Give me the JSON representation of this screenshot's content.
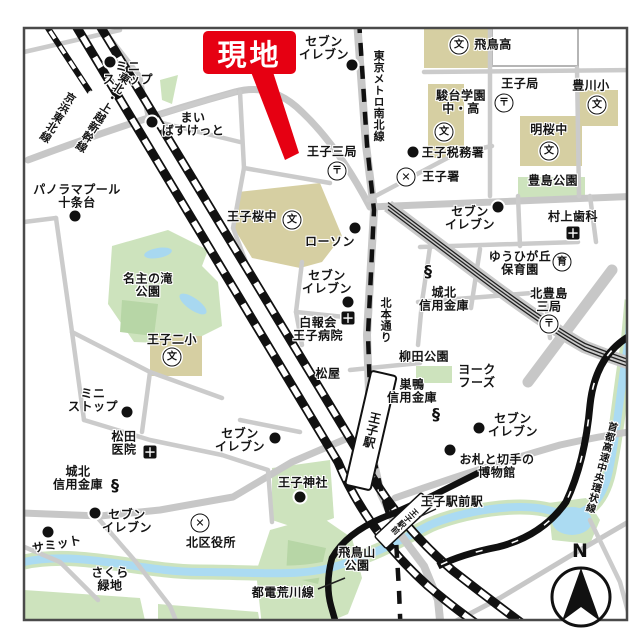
{
  "map": {
    "callout": {
      "text": "現地"
    },
    "compass_label": "N",
    "glyphs": {
      "dot": "",
      "school": "文",
      "post": "〒",
      "police": "✕",
      "hospital": "＋",
      "bank": "§",
      "nursery": "育"
    },
    "text_labels": [
      {
        "name": "label-ministop-top",
        "text": "ミニ\nストップ",
        "x": 128,
        "y": 74
      },
      {
        "name": "label-maibasuketto",
        "text": "まい\nばすけっと",
        "x": 193,
        "y": 125
      },
      {
        "name": "label-seven-eleven-top",
        "text": "セブン\nイレブン",
        "x": 324,
        "y": 49
      },
      {
        "name": "label-tokyo-metro-namboku-line",
        "text": "東京メトロ南北線",
        "x": 378,
        "y": 96,
        "v": 1,
        "size": 11
      },
      {
        "name": "label-oji-san-post-office",
        "text": "王子三局",
        "x": 332,
        "y": 152
      },
      {
        "name": "label-oji-tax-office",
        "text": "王子税務署",
        "x": 453,
        "y": 153
      },
      {
        "name": "label-oji-police-station",
        "text": "王子署",
        "x": 441,
        "y": 177
      },
      {
        "name": "label-asuka-high-school",
        "text": "飛鳥高",
        "x": 493,
        "y": 45
      },
      {
        "name": "label-sundai-gakuen",
        "text": "駿台学園\n中・高",
        "x": 461,
        "y": 103
      },
      {
        "name": "label-oji-post-office",
        "text": "王子局",
        "x": 520,
        "y": 84
      },
      {
        "name": "label-toyokawa-elementary",
        "text": "豊川小",
        "x": 591,
        "y": 86
      },
      {
        "name": "label-meio-middle-school",
        "text": "明桜中",
        "x": 549,
        "y": 130
      },
      {
        "name": "label-toshima-park",
        "text": "豊島公園",
        "x": 553,
        "y": 181
      },
      {
        "name": "label-murakami-dental",
        "text": "村上歯科",
        "x": 573,
        "y": 217
      },
      {
        "name": "label-seven-eleven-right",
        "text": "セブン\nイレブン",
        "x": 470,
        "y": 219
      },
      {
        "name": "label-yuhigaoka-nursery",
        "text": "ゆうひが丘\n保育園",
        "x": 520,
        "y": 264
      },
      {
        "name": "label-kitatoshima-post-office",
        "text": "北豊島\n三局",
        "x": 549,
        "y": 301
      },
      {
        "name": "label-johoku-shinkin-right",
        "text": "城北\n信用金庫",
        "x": 444,
        "y": 300
      },
      {
        "name": "label-yanagida-park",
        "text": "柳田公園",
        "x": 424,
        "y": 357
      },
      {
        "name": "label-york-foods",
        "text": "ヨーク\nフーズ",
        "x": 477,
        "y": 377
      },
      {
        "name": "label-sugamo-shinkin",
        "text": "巣鴨\n信用金庫",
        "x": 412,
        "y": 392
      },
      {
        "name": "label-seven-eleven-bottom-right",
        "text": "セブン\nイレブン",
        "x": 513,
        "y": 426
      },
      {
        "name": "label-stamp-museum",
        "text": "お札と切手の\n博物館",
        "x": 497,
        "y": 467
      },
      {
        "name": "label-oji-ekimae-station",
        "text": "王子駅前駅",
        "x": 452,
        "y": 502
      },
      {
        "name": "label-shuto-expressway",
        "text": "首都高速中央環状線",
        "x": 600,
        "y": 467,
        "v": 1,
        "rot": 15,
        "size": 10
      },
      {
        "name": "label-oji-station",
        "text": "王子駅",
        "x": 371,
        "y": 430,
        "v": 1,
        "rot": 13,
        "size": 12
      },
      {
        "name": "label-asukayama-park",
        "text": "飛鳥山\n公園",
        "x": 357,
        "y": 560
      },
      {
        "name": "label-toden-arakawa-line",
        "text": "都電荒川線",
        "x": 283,
        "y": 593
      },
      {
        "name": "label-oji-shrine",
        "text": "王子神社",
        "x": 303,
        "y": 483
      },
      {
        "name": "label-kita-ward-office",
        "text": "北区役所",
        "x": 211,
        "y": 543
      },
      {
        "name": "label-seven-eleven-bottom-center",
        "text": "セブン\nイレブン",
        "x": 240,
        "y": 441
      },
      {
        "name": "label-summit",
        "text": "サミット",
        "x": 57,
        "y": 545,
        "rot": -10
      },
      {
        "name": "label-seven-eleven-left",
        "text": "セブン\nイレブン",
        "x": 127,
        "y": 522
      },
      {
        "name": "label-johoku-shinkin-left",
        "text": "城北\n信用金庫",
        "x": 78,
        "y": 479
      },
      {
        "name": "label-matsuda-clinic",
        "text": "松田\n医院",
        "x": 124,
        "y": 444
      },
      {
        "name": "label-ministop-left",
        "text": "ミニ\nストップ",
        "x": 93,
        "y": 401
      },
      {
        "name": "label-sakura-ryokuchi",
        "text": "さくら\n緑地",
        "x": 110,
        "y": 580
      },
      {
        "name": "label-seven-eleven-mid",
        "text": "セブン\nイレブン",
        "x": 327,
        "y": 283
      },
      {
        "name": "label-hakuhokai-oji-hospital",
        "text": "白報会\n王子病院",
        "x": 318,
        "y": 330
      },
      {
        "name": "label-kitamoto-dori",
        "text": "北本通り",
        "x": 385,
        "y": 320,
        "v": 1,
        "size": 11
      },
      {
        "name": "label-matsuya",
        "text": "松屋",
        "x": 328,
        "y": 374
      },
      {
        "name": "label-nanushi-falls-park",
        "text": "名主の滝\n公園",
        "x": 148,
        "y": 286
      },
      {
        "name": "label-oji-2-elementary",
        "text": "王子二小",
        "x": 172,
        "y": 340
      },
      {
        "name": "label-panorama-pool",
        "text": "パノラマプール\n十条台",
        "x": 77,
        "y": 197
      },
      {
        "name": "label-oji-sakura-middle",
        "text": "王子桜中",
        "x": 252,
        "y": 217
      },
      {
        "name": "label-lawson",
        "text": "ローソン",
        "x": 330,
        "y": 242
      },
      {
        "name": "label-tohoku-joetsu-shinkansen",
        "text": "東北・上越新幹線",
        "x": 102,
        "y": 112,
        "v": 1,
        "rot": 32,
        "size": 11
      },
      {
        "name": "label-keihin-tohoku-line",
        "text": "京浜東北線",
        "x": 57,
        "y": 117,
        "v": 1,
        "rot": 32,
        "size": 11
      },
      {
        "name": "label-oji-ekimae-box",
        "text": "王子駅前",
        "x": 404,
        "y": 521,
        "v": 1,
        "rot": 47,
        "size": 8
      }
    ],
    "poi_icons": [
      {
        "name": "icon-ministop-top-dot",
        "kind": "dot",
        "x": 110,
        "y": 62
      },
      {
        "name": "icon-maibasuketto-dot",
        "kind": "dot",
        "x": 152,
        "y": 122
      },
      {
        "name": "icon-seven-top-dot",
        "kind": "dot",
        "x": 352,
        "y": 65
      },
      {
        "name": "icon-oji-tax-dot",
        "kind": "dot",
        "x": 413,
        "y": 152
      },
      {
        "name": "icon-seven-right-dot",
        "kind": "dot",
        "x": 498,
        "y": 207
      },
      {
        "name": "icon-seven-bottom-right-dot",
        "kind": "dot",
        "x": 479,
        "y": 428
      },
      {
        "name": "icon-stamp-museum-dot",
        "kind": "dot",
        "x": 450,
        "y": 450
      },
      {
        "name": "icon-oji-shrine-dot",
        "kind": "dot",
        "x": 300,
        "y": 497
      },
      {
        "name": "icon-seven-bottom-center-dot",
        "kind": "dot",
        "x": 275,
        "y": 438
      },
      {
        "name": "icon-summit-dot",
        "kind": "dot",
        "x": 48,
        "y": 532
      },
      {
        "name": "icon-seven-left-dot",
        "kind": "dot",
        "x": 95,
        "y": 513
      },
      {
        "name": "icon-ministop-left-dot",
        "kind": "dot",
        "x": 127,
        "y": 412
      },
      {
        "name": "icon-seven-mid-dot",
        "kind": "dot",
        "x": 348,
        "y": 302
      },
      {
        "name": "icon-panorama-pool-dot",
        "kind": "dot",
        "x": 75,
        "y": 216
      },
      {
        "name": "icon-lawson-dot",
        "kind": "dot",
        "x": 355,
        "y": 228
      },
      {
        "name": "icon-asuka-high-school",
        "kind": "school",
        "x": 459,
        "y": 45
      },
      {
        "name": "icon-sundai-school",
        "kind": "school",
        "x": 444,
        "y": 132
      },
      {
        "name": "icon-toyokawa-school",
        "kind": "school",
        "x": 597,
        "y": 105
      },
      {
        "name": "icon-meio-school",
        "kind": "school",
        "x": 549,
        "y": 151
      },
      {
        "name": "icon-oji-2-school",
        "kind": "school",
        "x": 172,
        "y": 357
      },
      {
        "name": "icon-oji-sakura-school",
        "kind": "school",
        "x": 292,
        "y": 220
      },
      {
        "name": "icon-oji-san-post",
        "kind": "post",
        "x": 337,
        "y": 171
      },
      {
        "name": "icon-oji-post",
        "kind": "post",
        "x": 504,
        "y": 103
      },
      {
        "name": "icon-kitatoshima-post",
        "kind": "post",
        "x": 549,
        "y": 324
      },
      {
        "name": "icon-oji-police",
        "kind": "police",
        "x": 406,
        "y": 177
      },
      {
        "name": "icon-kita-ward-office",
        "kind": "police",
        "x": 200,
        "y": 523
      },
      {
        "name": "icon-murakami-hospital",
        "kind": "hospital",
        "x": 573,
        "y": 233
      },
      {
        "name": "icon-hakuhokai-hospital",
        "kind": "hospital",
        "x": 348,
        "y": 318
      },
      {
        "name": "icon-matsuda-hospital",
        "kind": "hospital",
        "x": 150,
        "y": 452
      },
      {
        "name": "icon-johoku-bank-right",
        "kind": "bank",
        "x": 428,
        "y": 271
      },
      {
        "name": "icon-sugamo-bank",
        "kind": "bank",
        "x": 436,
        "y": 414
      },
      {
        "name": "icon-johoku-bank-left",
        "kind": "bank",
        "x": 115,
        "y": 485
      },
      {
        "name": "icon-yuhigaoka-nursery",
        "kind": "nursery",
        "x": 562,
        "y": 262
      }
    ]
  }
}
